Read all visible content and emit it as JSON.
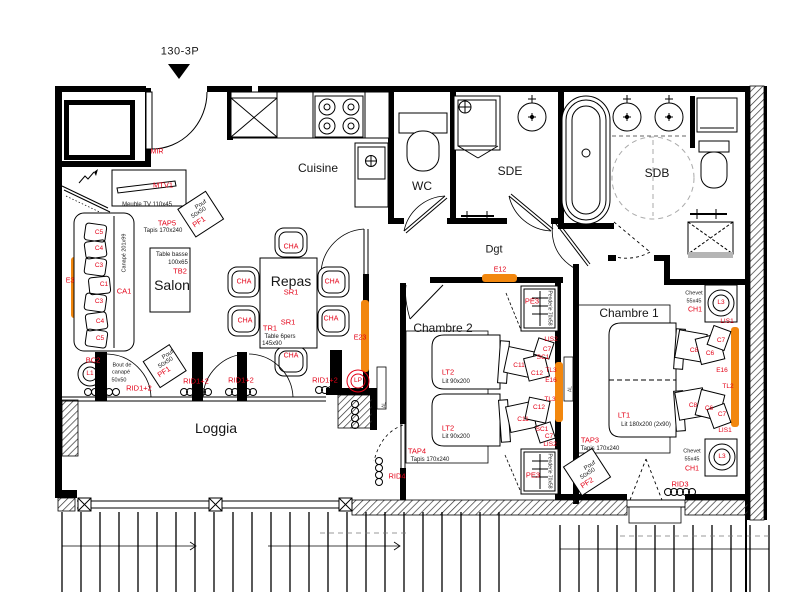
{
  "plan_number": "130-3P",
  "colors": {
    "annotation_red": "#e30016",
    "window_orange": "#F2870E",
    "wall_black": "#000000",
    "washer_gray": "#b5b5b5"
  },
  "rooms": [
    "Cuisine",
    "WC",
    "SDE",
    "SDB",
    "Dgt",
    "Salon",
    "Repas",
    "Chambre 1",
    "Chambre 2",
    "Loggia"
  ],
  "labels": [
    {
      "n": "room-label-cuisine",
      "t": "Cuisine",
      "x": 318,
      "y": 168,
      "c": "k",
      "s": 12
    },
    {
      "n": "room-label-wc",
      "t": "WC",
      "x": 422,
      "y": 186,
      "c": "k",
      "s": 12
    },
    {
      "n": "room-label-sde",
      "t": "SDE",
      "x": 510,
      "y": 171,
      "c": "k",
      "s": 12
    },
    {
      "n": "room-label-sdb",
      "t": "SDB",
      "x": 657,
      "y": 173,
      "c": "k",
      "s": 12
    },
    {
      "n": "room-label-dgt",
      "t": "Dgt",
      "x": 494,
      "y": 250,
      "c": "k",
      "s": 11
    },
    {
      "n": "room-label-salon",
      "t": "Salon",
      "x": 172,
      "y": 285,
      "c": "k",
      "s": 14
    },
    {
      "n": "room-label-repas",
      "t": "Repas",
      "x": 291,
      "y": 281,
      "c": "k",
      "s": 14
    },
    {
      "n": "room-label-chambre2",
      "t": "Chambre 2",
      "x": 443,
      "y": 328,
      "c": "k",
      "s": 12
    },
    {
      "n": "room-label-chambre1",
      "t": "Chambre 1",
      "x": 629,
      "y": 313,
      "c": "k",
      "s": 12
    },
    {
      "n": "room-label-loggia",
      "t": "Loggia",
      "x": 216,
      "y": 428,
      "c": "k",
      "s": 14
    },
    {
      "n": "label-mir",
      "t": "MIR",
      "x": 157,
      "y": 152,
      "c": "r",
      "s": 7
    },
    {
      "n": "label-mtv1",
      "t": "MTV1",
      "x": 163,
      "y": 185,
      "c": "r",
      "s": 7.5
    },
    {
      "n": "label-meuble-tv",
      "t": "Meuble TV 110x45",
      "x": 147,
      "y": 205,
      "c": "k",
      "s": 6
    },
    {
      "n": "label-tap5",
      "t": "TAP5",
      "x": 167,
      "y": 223,
      "c": "r",
      "s": 7.5
    },
    {
      "n": "label-tapis-tap5",
      "t": "Tapis 170x240",
      "x": 163,
      "y": 231,
      "c": "k",
      "s": 6
    },
    {
      "n": "label-pouf1-l1",
      "t": "Pouf",
      "x": 201,
      "y": 205,
      "c": "k",
      "s": 6,
      "rot": -33
    },
    {
      "n": "label-pouf1-l2",
      "t": "50x50",
      "x": 199,
      "y": 213,
      "c": "k",
      "s": 6,
      "rot": -33
    },
    {
      "n": "label-pf1-top",
      "t": "PF1",
      "x": 199,
      "y": 222,
      "c": "r",
      "s": 7.5,
      "rot": -33
    },
    {
      "n": "label-canape-dim",
      "t": "Canapé 201x99",
      "x": 125,
      "y": 253,
      "c": "k",
      "s": 5.5,
      "rot": -90
    },
    {
      "n": "label-c5a",
      "t": "C5",
      "x": 99,
      "y": 233,
      "c": "r",
      "s": 6.5
    },
    {
      "n": "label-c4a",
      "t": "C4",
      "x": 99,
      "y": 249,
      "c": "r",
      "s": 6.5
    },
    {
      "n": "label-c3a",
      "t": "C3",
      "x": 99,
      "y": 266,
      "c": "r",
      "s": 6.5
    },
    {
      "n": "label-c1",
      "t": "C1",
      "x": 104,
      "y": 285,
      "c": "r",
      "s": 6.5
    },
    {
      "n": "label-c3b",
      "t": "C3",
      "x": 99,
      "y": 302,
      "c": "r",
      "s": 6.5
    },
    {
      "n": "label-c4b",
      "t": "C4",
      "x": 100,
      "y": 322,
      "c": "r",
      "s": 6.5
    },
    {
      "n": "label-c5b",
      "t": "C5",
      "x": 100,
      "y": 339,
      "c": "r",
      "s": 6.5
    },
    {
      "n": "label-ca1",
      "t": "CA1",
      "x": 124,
      "y": 291,
      "c": "r",
      "s": 7.5
    },
    {
      "n": "label-e3",
      "t": "E3",
      "x": 70,
      "y": 281,
      "c": "r",
      "s": 7
    },
    {
      "n": "label-table-basse",
      "t": "Table basse",
      "x": 172,
      "y": 255,
      "c": "k",
      "s": 6
    },
    {
      "n": "label-table-basse-dim",
      "t": "100x65",
      "x": 178,
      "y": 263,
      "c": "k",
      "s": 6
    },
    {
      "n": "label-tb2",
      "t": "TB2",
      "x": 180,
      "y": 271,
      "c": "r",
      "s": 7.5
    },
    {
      "n": "label-bc2",
      "t": "BC2",
      "x": 93,
      "y": 360,
      "c": "r",
      "s": 7.5
    },
    {
      "n": "label-l1",
      "t": "L1",
      "x": 90,
      "y": 374,
      "c": "r",
      "s": 6.5
    },
    {
      "n": "label-bout-1",
      "t": "Bout de",
      "x": 122,
      "y": 366,
      "c": "k",
      "s": 5.5
    },
    {
      "n": "label-bout-2",
      "t": "canapé",
      "x": 121,
      "y": 373,
      "c": "k",
      "s": 5.5
    },
    {
      "n": "label-bout-3",
      "t": "50x50",
      "x": 119,
      "y": 381,
      "c": "k",
      "s": 5.5
    },
    {
      "n": "label-pouf2-l1",
      "t": "Pouf",
      "x": 168,
      "y": 355,
      "c": "k",
      "s": 6,
      "rot": -33
    },
    {
      "n": "label-pouf2-l2",
      "t": "50x50",
      "x": 166,
      "y": 363,
      "c": "k",
      "s": 6,
      "rot": -33
    },
    {
      "n": "label-pf1-bottom",
      "t": "PF1",
      "x": 164,
      "y": 372,
      "c": "r",
      "s": 7.5,
      "rot": -33
    },
    {
      "n": "label-rid12-1",
      "t": "RID1+2",
      "x": 139,
      "y": 388,
      "c": "r",
      "s": 7.5
    },
    {
      "n": "label-rid12-2",
      "t": "RID1+2",
      "x": 196,
      "y": 381,
      "c": "r",
      "s": 7.5
    },
    {
      "n": "label-rid12-3",
      "t": "RID1+2",
      "x": 241,
      "y": 380,
      "c": "r",
      "s": 7.5
    },
    {
      "n": "label-rid12-4",
      "t": "RID1+2",
      "x": 325,
      "y": 380,
      "c": "r",
      "s": 7.5
    },
    {
      "n": "label-sr1-a",
      "t": "SR1",
      "x": 291,
      "y": 292,
      "c": "r",
      "s": 7.5
    },
    {
      "n": "label-sr1-b",
      "t": "SR1",
      "x": 288,
      "y": 322,
      "c": "r",
      "s": 7.5
    },
    {
      "n": "label-tr1",
      "t": "TR1",
      "x": 270,
      "y": 328,
      "c": "r",
      "s": 7.5
    },
    {
      "n": "label-table-6pers",
      "t": "Table 6pers",
      "x": 280,
      "y": 337,
      "c": "k",
      "s": 6
    },
    {
      "n": "label-table-6pers-dim",
      "t": "145x90",
      "x": 272,
      "y": 344,
      "c": "k",
      "s": 6
    },
    {
      "n": "label-cha-top",
      "t": "CHA",
      "x": 291,
      "y": 247,
      "c": "r",
      "s": 7
    },
    {
      "n": "label-cha-l1",
      "t": "CHA",
      "x": 244,
      "y": 282,
      "c": "r",
      "s": 7
    },
    {
      "n": "label-cha-l2",
      "t": "CHA",
      "x": 245,
      "y": 321,
      "c": "r",
      "s": 7
    },
    {
      "n": "label-cha-r1",
      "t": "CHA",
      "x": 332,
      "y": 282,
      "c": "r",
      "s": 7
    },
    {
      "n": "label-cha-r2",
      "t": "CHA",
      "x": 331,
      "y": 319,
      "c": "r",
      "s": 7
    },
    {
      "n": "label-cha-bottom",
      "t": "CHA",
      "x": 291,
      "y": 356,
      "c": "r",
      "s": 7
    },
    {
      "n": "label-e23",
      "t": "E23",
      "x": 360,
      "y": 338,
      "c": "r",
      "s": 7
    },
    {
      "n": "label-lp",
      "t": "LP",
      "x": 358,
      "y": 381,
      "c": "r",
      "s": 6.5
    },
    {
      "n": "label-e12",
      "t": "E12",
      "x": 500,
      "y": 270,
      "c": "r",
      "s": 7
    },
    {
      "n": "label-pe3-top",
      "t": "PE3",
      "x": 532,
      "y": 301,
      "c": "r",
      "s": 7.5
    },
    {
      "n": "label-penderie-top",
      "t": "Penderie 70x58",
      "x": 549,
      "y": 308,
      "c": "k",
      "s": 5,
      "rot": 90
    },
    {
      "n": "label-lis2-a",
      "t": "LIS2",
      "x": 551,
      "y": 340,
      "c": "r",
      "s": 6.5
    },
    {
      "n": "label-c7-ch2a",
      "t": "C7",
      "x": 547,
      "y": 350,
      "c": "r",
      "s": 6.5
    },
    {
      "n": "label-sc1-a",
      "t": "SC1",
      "x": 543,
      "y": 358,
      "c": "r",
      "s": 6.5
    },
    {
      "n": "label-c11-a",
      "t": "C11",
      "x": 519,
      "y": 366,
      "c": "r",
      "s": 6.5
    },
    {
      "n": "label-c12-a",
      "t": "C12",
      "x": 537,
      "y": 374,
      "c": "r",
      "s": 6.5
    },
    {
      "n": "label-tl3-a",
      "t": "TL3",
      "x": 551,
      "y": 371,
      "c": "r",
      "s": 6.5
    },
    {
      "n": "label-e16-ch2",
      "t": "E16",
      "x": 551,
      "y": 381,
      "c": "r",
      "s": 6.5
    },
    {
      "n": "label-lt2-a",
      "t": "LT2",
      "x": 448,
      "y": 372,
      "c": "r",
      "s": 7.5
    },
    {
      "n": "label-lit90-a",
      "t": "Lit 90x200",
      "x": 456,
      "y": 382,
      "c": "k",
      "s": 6
    },
    {
      "n": "label-tl3-b",
      "t": "TL3",
      "x": 550,
      "y": 400,
      "c": "r",
      "s": 6.5
    },
    {
      "n": "label-c12-b",
      "t": "C12",
      "x": 539,
      "y": 408,
      "c": "r",
      "s": 6.5
    },
    {
      "n": "label-c11-b",
      "t": "C11",
      "x": 523,
      "y": 420,
      "c": "r",
      "s": 6.5
    },
    {
      "n": "label-sc1-b",
      "t": "SC1",
      "x": 542,
      "y": 430,
      "c": "r",
      "s": 6.5
    },
    {
      "n": "label-c7-ch2b",
      "t": "C7",
      "x": 549,
      "y": 437,
      "c": "r",
      "s": 6.5
    },
    {
      "n": "label-lis2-b",
      "t": "LIS2",
      "x": 550,
      "y": 445,
      "c": "r",
      "s": 6.5
    },
    {
      "n": "label-lt2-b",
      "t": "LT2",
      "x": 448,
      "y": 428,
      "c": "r",
      "s": 7.5
    },
    {
      "n": "label-lit90-b",
      "t": "Lit 90x200",
      "x": 456,
      "y": 437,
      "c": "k",
      "s": 6
    },
    {
      "n": "label-pe3-bottom",
      "t": "PE3",
      "x": 533,
      "y": 475,
      "c": "r",
      "s": 7.5
    },
    {
      "n": "label-penderie-bottom",
      "t": "Penderie 70x58",
      "x": 549,
      "y": 471,
      "c": "k",
      "s": 5,
      "rot": 90
    },
    {
      "n": "label-tap4",
      "t": "TAP4",
      "x": 417,
      "y": 451,
      "c": "r",
      "s": 7.5
    },
    {
      "n": "label-tapis-tap4",
      "t": "Tapis 170x240",
      "x": 430,
      "y": 460,
      "c": "k",
      "s": 6
    },
    {
      "n": "label-rid4",
      "t": "RID4",
      "x": 397,
      "y": 476,
      "c": "r",
      "s": 7.5
    },
    {
      "n": "label-al-1",
      "t": "AL",
      "x": 385,
      "y": 405,
      "c": "g",
      "s": 5,
      "rot": -90
    },
    {
      "n": "label-chevet-top-1",
      "t": "Chevet",
      "x": 694,
      "y": 294,
      "c": "k",
      "s": 5.5
    },
    {
      "n": "label-chevet-top-2",
      "t": "55x45",
      "x": 694,
      "y": 302,
      "c": "k",
      "s": 5.5
    },
    {
      "n": "label-ch1-top",
      "t": "CH1",
      "x": 695,
      "y": 310,
      "c": "r",
      "s": 7
    },
    {
      "n": "label-l3-top",
      "t": "L3",
      "x": 721,
      "y": 303,
      "c": "r",
      "s": 6.5
    },
    {
      "n": "label-lis1-top",
      "t": "LIS1",
      "x": 727,
      "y": 322,
      "c": "r",
      "s": 6.5
    },
    {
      "n": "label-c7-ch1a",
      "t": "C7",
      "x": 721,
      "y": 341,
      "c": "r",
      "s": 6.5
    },
    {
      "n": "label-c8-a",
      "t": "C8",
      "x": 694,
      "y": 351,
      "c": "r",
      "s": 6.5
    },
    {
      "n": "label-c6-a",
      "t": "C6",
      "x": 710,
      "y": 354,
      "c": "r",
      "s": 6.5
    },
    {
      "n": "label-e16-ch1",
      "t": "E16",
      "x": 722,
      "y": 371,
      "c": "r",
      "s": 6.5
    },
    {
      "n": "label-tl2",
      "t": "TL2",
      "x": 728,
      "y": 387,
      "c": "r",
      "s": 6.5
    },
    {
      "n": "label-c8-b",
      "t": "C8",
      "x": 693,
      "y": 406,
      "c": "r",
      "s": 6.5
    },
    {
      "n": "label-c6-b",
      "t": "C6",
      "x": 709,
      "y": 409,
      "c": "r",
      "s": 6.5
    },
    {
      "n": "label-c7-ch1b",
      "t": "C7",
      "x": 722,
      "y": 415,
      "c": "r",
      "s": 6.5
    },
    {
      "n": "label-lis1-bottom",
      "t": "LIS1",
      "x": 725,
      "y": 431,
      "c": "r",
      "s": 6.5
    },
    {
      "n": "label-lt1",
      "t": "LT1",
      "x": 624,
      "y": 415,
      "c": "r",
      "s": 7.5
    },
    {
      "n": "label-lit180",
      "t": "Lit 180x200 (2x90)",
      "x": 646,
      "y": 425,
      "c": "k",
      "s": 6
    },
    {
      "n": "label-tap3",
      "t": "TAP3",
      "x": 590,
      "y": 440,
      "c": "r",
      "s": 7.5
    },
    {
      "n": "label-tapis-tap3",
      "t": "Tapis 170x240",
      "x": 600,
      "y": 449,
      "c": "k",
      "s": 6
    },
    {
      "n": "label-pouf3-l1",
      "t": "Pouf",
      "x": 590,
      "y": 466,
      "c": "k",
      "s": 6,
      "rot": -33
    },
    {
      "n": "label-pouf3-l2",
      "t": "50x50",
      "x": 588,
      "y": 474,
      "c": "k",
      "s": 6,
      "rot": -33
    },
    {
      "n": "label-pf2",
      "t": "PF2",
      "x": 587,
      "y": 483,
      "c": "r",
      "s": 7.5,
      "rot": -33
    },
    {
      "n": "label-chevet-bot-1",
      "t": "Chevet",
      "x": 692,
      "y": 452,
      "c": "k",
      "s": 5.5
    },
    {
      "n": "label-chevet-bot-2",
      "t": "55x45",
      "x": 692,
      "y": 460,
      "c": "k",
      "s": 5.5
    },
    {
      "n": "label-ch1-bottom",
      "t": "CH1",
      "x": 692,
      "y": 469,
      "c": "r",
      "s": 7
    },
    {
      "n": "label-l3-bottom",
      "t": "L3",
      "x": 722,
      "y": 457,
      "c": "r",
      "s": 6.5
    },
    {
      "n": "label-rid3",
      "t": "RID3",
      "x": 680,
      "y": 484,
      "c": "r",
      "s": 7.5
    },
    {
      "n": "label-al-2",
      "t": "AL",
      "x": 571,
      "y": 389,
      "c": "g",
      "s": 5,
      "rot": -90
    }
  ]
}
